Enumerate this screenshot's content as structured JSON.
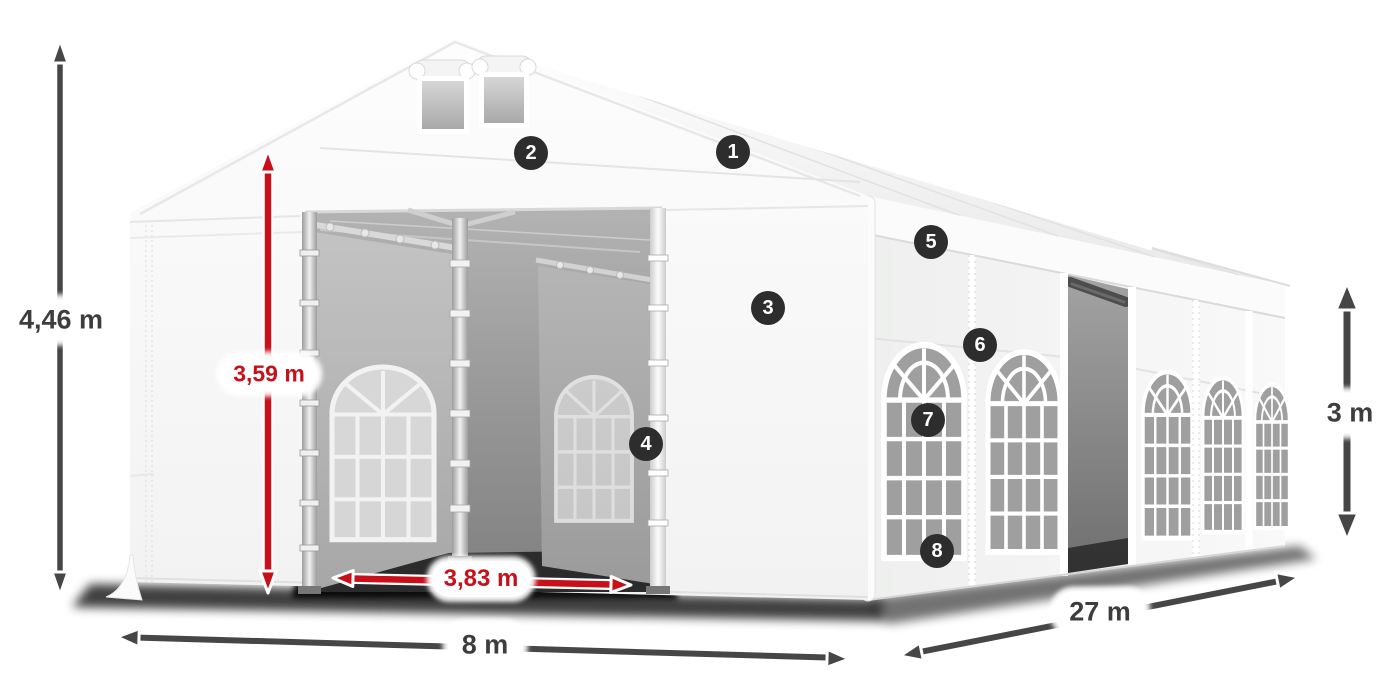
{
  "diagram": {
    "dimensions": {
      "total_height": "4,46 m",
      "entrance_height": "3,59 m",
      "entrance_width": "3,83 m",
      "front_width": "8 m",
      "side_length": "27 m",
      "side_height": "3 m"
    },
    "badges": [
      "1",
      "2",
      "3",
      "4",
      "5",
      "6",
      "7",
      "8"
    ],
    "colors": {
      "arrow_dark": "#464646",
      "arrow_red": "#c8101a",
      "label_dark": "#3d3d3d",
      "label_red": "#c8101a",
      "badge_bg": "#2d2d2d",
      "badge_text": "#ffffff",
      "pill_bg": "#ffffff"
    }
  }
}
